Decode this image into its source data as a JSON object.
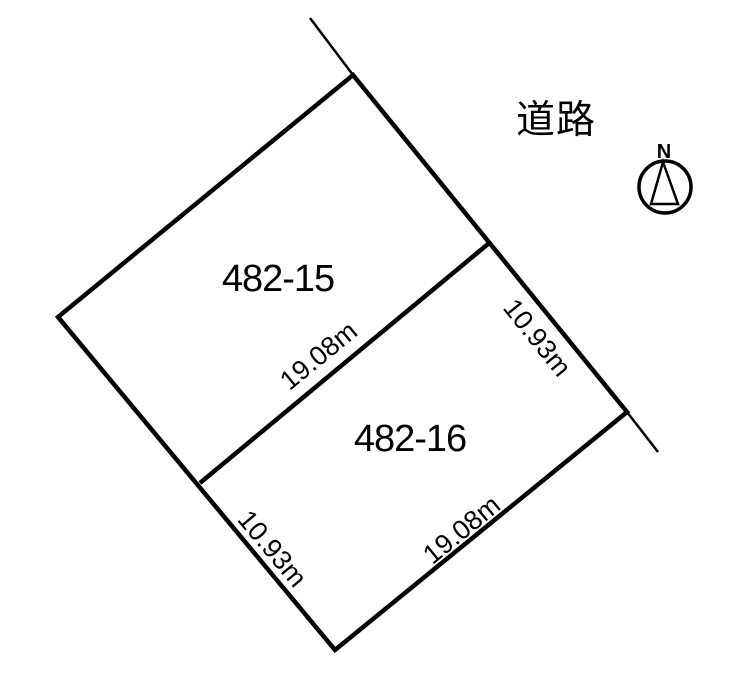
{
  "plot_plan": {
    "road_label": "道路",
    "compass": {
      "north_label": "N"
    },
    "parcels": [
      {
        "number": "482-15"
      },
      {
        "number": "482-16"
      }
    ],
    "dimensions": {
      "divider": "19.08m",
      "road_side": "10.93m",
      "southeast_side": "19.08m",
      "southwest_side": "10.93m"
    },
    "style": {
      "line_color": "#000000",
      "text_color": "#000000",
      "background": "#ffffff"
    }
  }
}
